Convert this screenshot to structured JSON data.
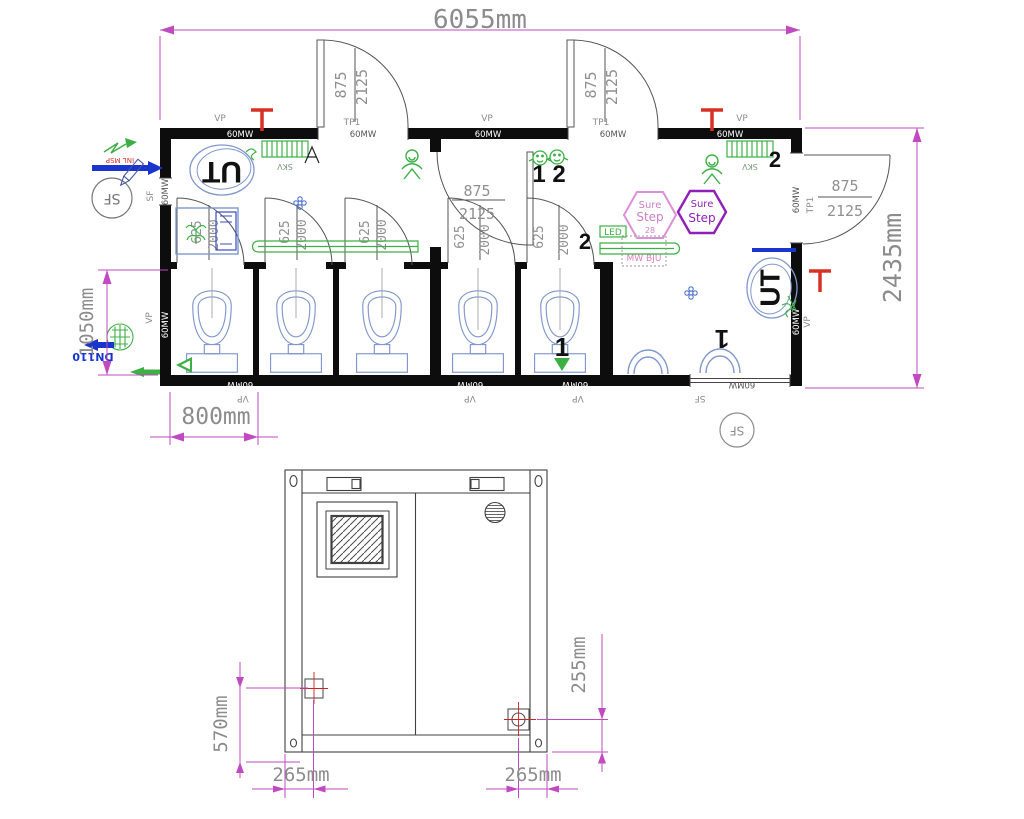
{
  "drawing": {
    "plan": {
      "dim_width": "6055mm",
      "dim_height": "2435mm",
      "dim_front": "1050mm",
      "dim_stall": "800mm",
      "door_width": "875",
      "door_height": "2125",
      "stall_door_width": "625",
      "stall_door_height": "2000",
      "door_tag": "TP1",
      "panel_label": "60MW",
      "vp_label": "VP",
      "sf_label": "SF",
      "heater_label": "SKV",
      "ut_label": "UT",
      "drain_label": "DN110",
      "led_label": "LED",
      "sensor_label": "MW BJU",
      "pipe_label": "INL MSP",
      "hex_badge_1": {
        "l1": "Sure",
        "l2": "Step",
        "l3": "28"
      },
      "hex_badge_2": {
        "l1": "Sure",
        "l2": "Step"
      },
      "count_12": "1 2",
      "count_1": "1",
      "count_2": "2"
    },
    "elevation": {
      "dim_side": "570mm",
      "dim_left": "265mm",
      "dim_right": "265mm",
      "dim_height": "255mm"
    }
  }
}
